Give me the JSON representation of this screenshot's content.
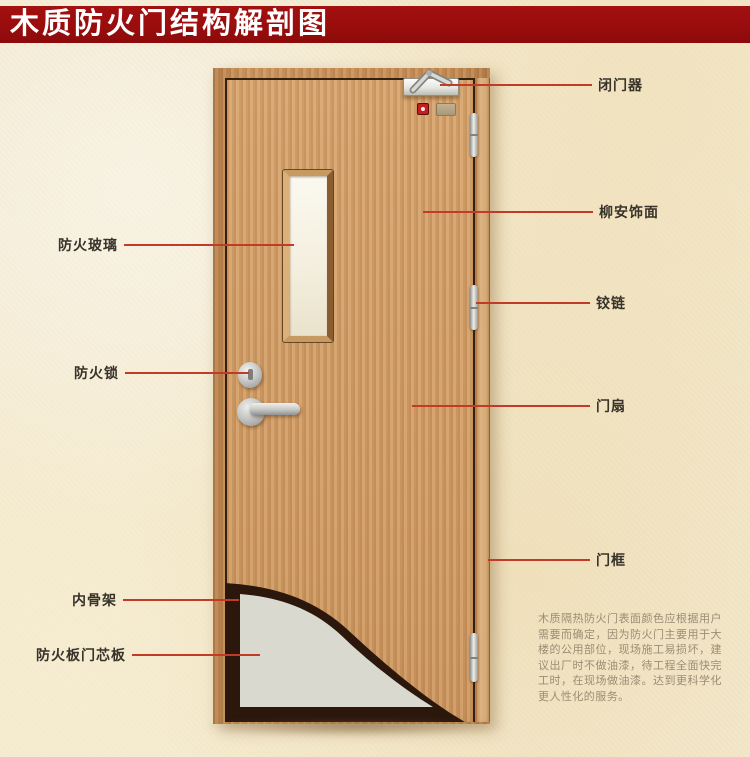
{
  "title": "木质防火门结构解剖图",
  "annotations": {
    "fire_glass": "防火玻璃",
    "fire_lock": "防火锁",
    "inner_frame": "内骨架",
    "core_board": "防火板门芯板",
    "door_closer": "闭门器",
    "veneer": "柳安饰面",
    "hinge": "铰链",
    "door_leaf": "门扇",
    "door_frame": "门框"
  },
  "description": "木质隔热防火门表面颜色应根据用户需要而确定，因为防火门主要用于大楼的公用部位，现场施工易损坏，建议出厂时不做油漆，待工程全面快完工时，在现场做油漆。达到更科学化更人性化的服务。",
  "colors": {
    "banner": "#9a0d0d",
    "leader_line": "#c23a28",
    "door_wood": "#d09a63",
    "core_panel": "#d9d9d0",
    "inner_skeleton": "#2b170c",
    "background": "#f3e9cf"
  }
}
